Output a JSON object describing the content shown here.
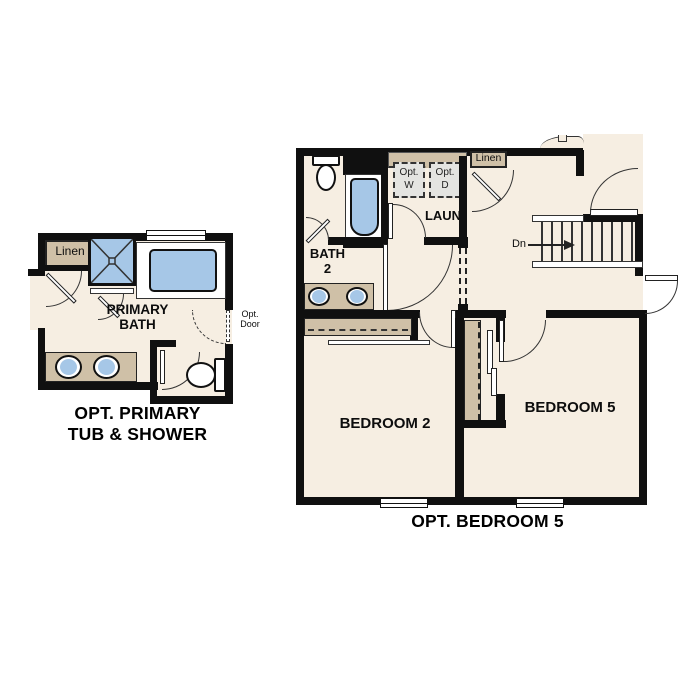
{
  "page": {
    "background": "#ffffff"
  },
  "colors": {
    "floor": "#f6eee2",
    "wall": "#101010",
    "cabinet_tan": "#cfc0a7",
    "fixture_blue": "#a6c7e7",
    "appliance_gray": "#e4e4e1"
  },
  "left_plan": {
    "title_line1": "OPT. PRIMARY",
    "title_line2": "TUB & SHOWER",
    "labels": {
      "linen": "Linen",
      "room_line1": "PRIMARY",
      "room_line2": "BATH",
      "opt_door_line1": "Opt.",
      "opt_door_line2": "Door"
    }
  },
  "right_plan": {
    "title": "OPT. BEDROOM 5",
    "labels": {
      "bath_line1": "BATH",
      "bath_line2": "2",
      "laundry": "LAUN",
      "washer_line1": "Opt.",
      "washer_line2": "W",
      "dryer_line1": "Opt.",
      "dryer_line2": "D",
      "linen": "Linen",
      "stairs_down": "Dn",
      "bedroom2": "BEDROOM 2",
      "bedroom5": "BEDROOM 5"
    }
  }
}
